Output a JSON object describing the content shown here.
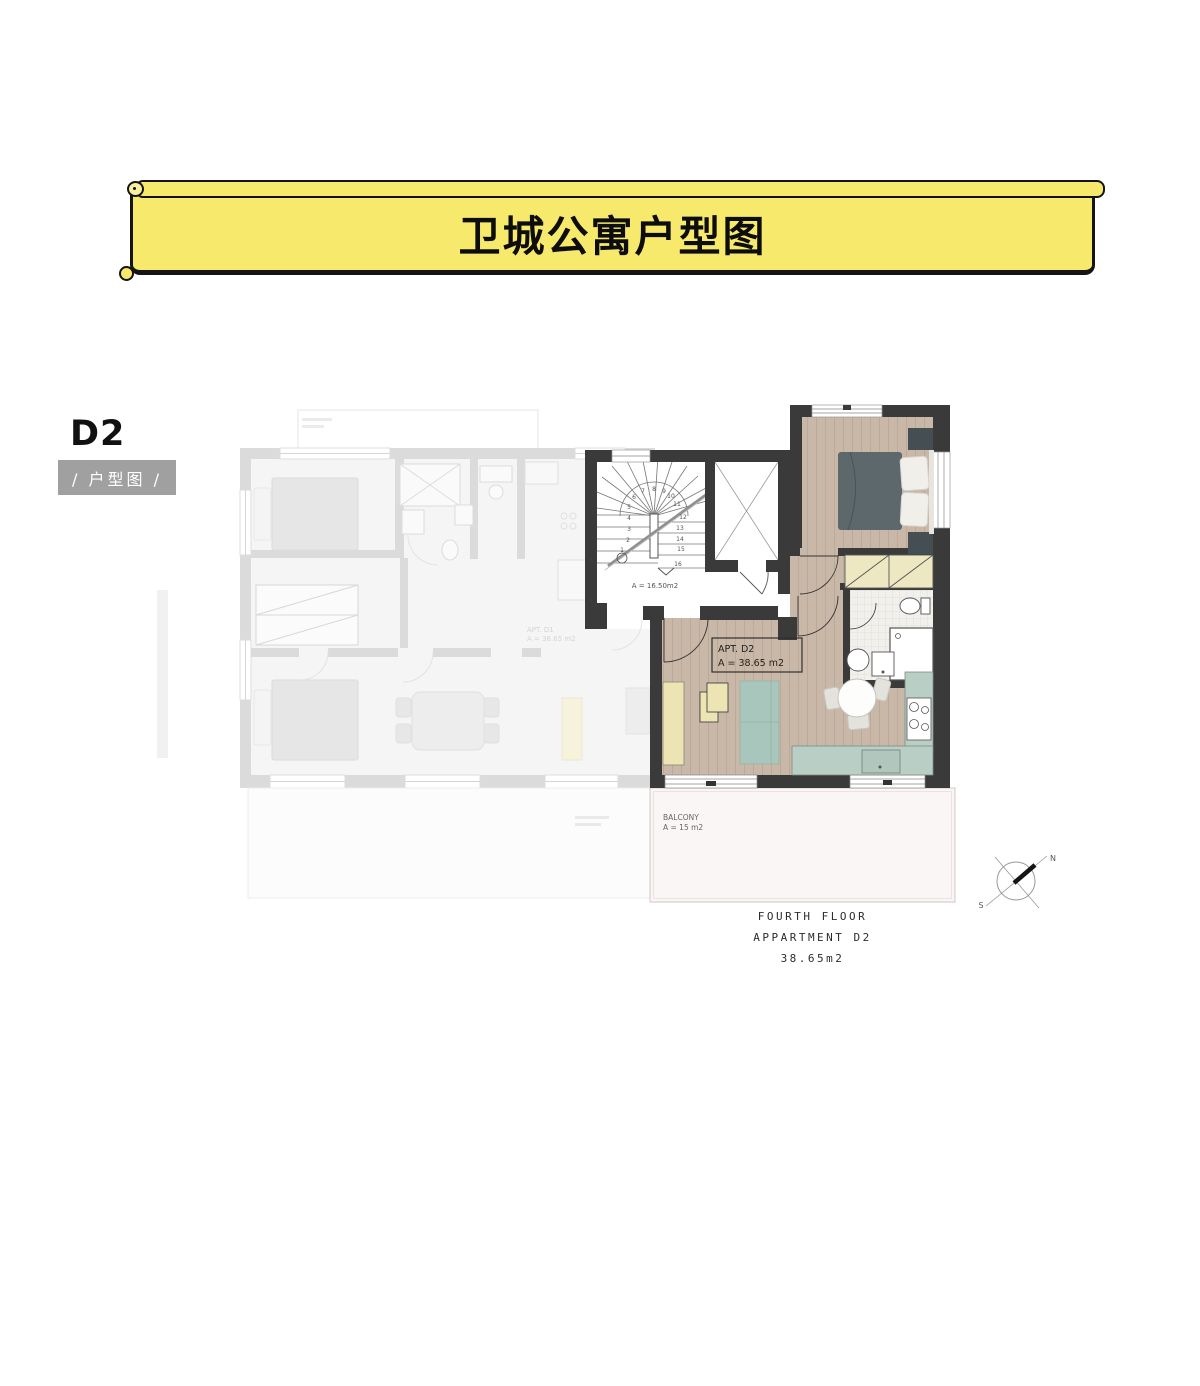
{
  "banner": {
    "title": "卫城公寓户型图",
    "fill": "#f6e96b",
    "border": "#141414"
  },
  "unit": {
    "code": "D2",
    "badge": "/ 户型图 /",
    "badge_bg": "#a0a0a0"
  },
  "plan": {
    "colors": {
      "wall": "#3a3a3a",
      "faded_wall": "#dbdbdb",
      "wood": "#c9b8a8",
      "sofa_teal": "#a8c6bb",
      "counter_teal": "#b9cfc5",
      "furniture_yellow": "#ece5b3",
      "wardrobe_yellow": "#ede7c2",
      "balcony": "#faf6f5"
    },
    "apartment_label": {
      "line1": "APT. D2",
      "line2": "A = 38.65 m2"
    },
    "stair_area_label": "A = 16.50m2",
    "stair_numbers": [
      "1",
      "2",
      "3",
      "4",
      "5",
      "6",
      "7",
      "8",
      "9",
      "10",
      "11",
      "12",
      "13",
      "14",
      "15",
      "16"
    ],
    "balcony_label": {
      "line1": "BALCONY",
      "line2": "A = 15 m2"
    },
    "adjacent_unit_label": {
      "line1": "APT. D1",
      "line2": "A = 38.65 m2"
    }
  },
  "compass": {
    "north": "N",
    "south": "S"
  },
  "caption": {
    "line1": "FOURTH FLOOR",
    "line2": "APPARTMENT D2",
    "line3": "38.65m2"
  }
}
